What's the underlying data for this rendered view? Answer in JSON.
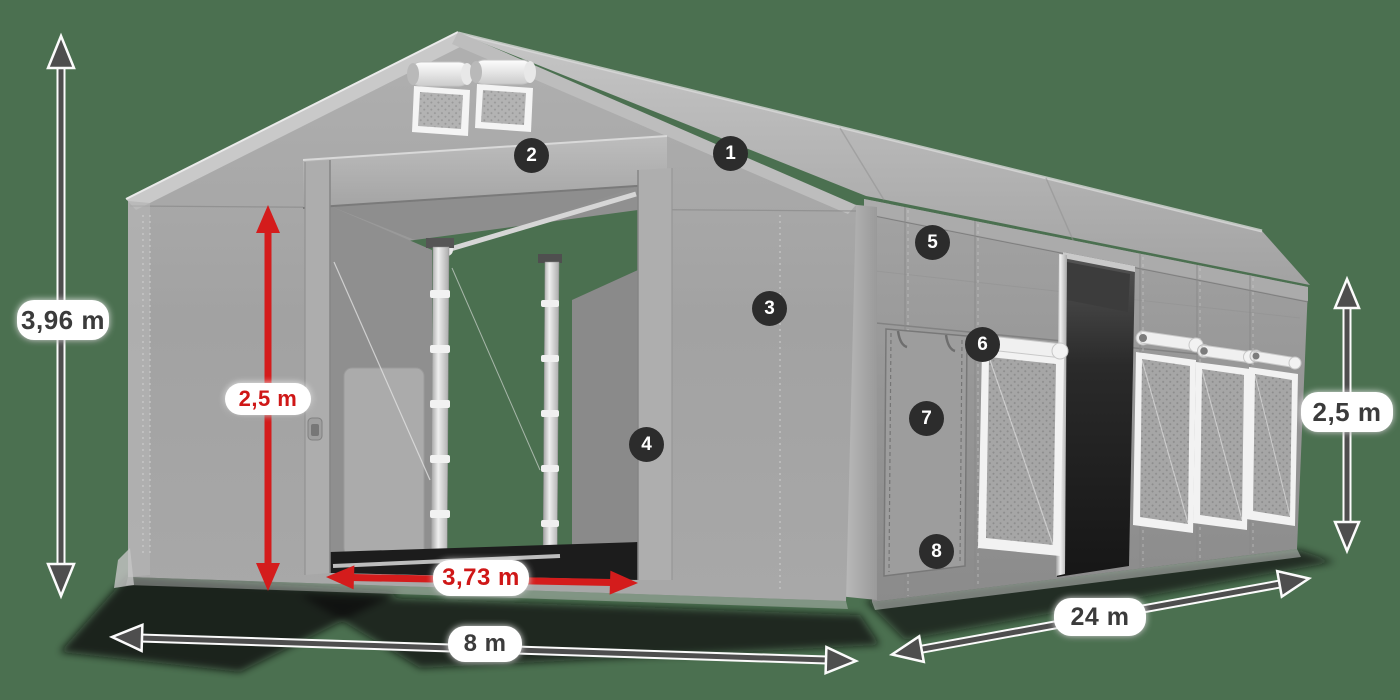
{
  "scene": {
    "subject": "Industrial storage tent with dimension annotations",
    "background_color": "#4B7050"
  },
  "dimensions": {
    "total_height": "3,96 m",
    "entrance_height": "2,5 m",
    "entrance_width": "3,73 m",
    "front_width": "8 m",
    "side_length": "24 m",
    "side_wall_height": "2,5 m"
  },
  "callouts": [
    "1",
    "2",
    "3",
    "4",
    "5",
    "6",
    "7",
    "8"
  ],
  "colors": {
    "background": "#4B7050",
    "dimension_text_dark": "#3B3B3B",
    "dimension_text_red": "#CF1717",
    "arrow_dark": "#4E4E4E",
    "arrow_red": "#D41C1C",
    "badge_background": "#2C2C2C",
    "badge_text": "#FFFFFF",
    "label_background": "#FFFFFF",
    "tent_light": "#B5B5B5",
    "tent_mid": "#9B9B9B",
    "tent_dark": "#1E1E1E"
  }
}
